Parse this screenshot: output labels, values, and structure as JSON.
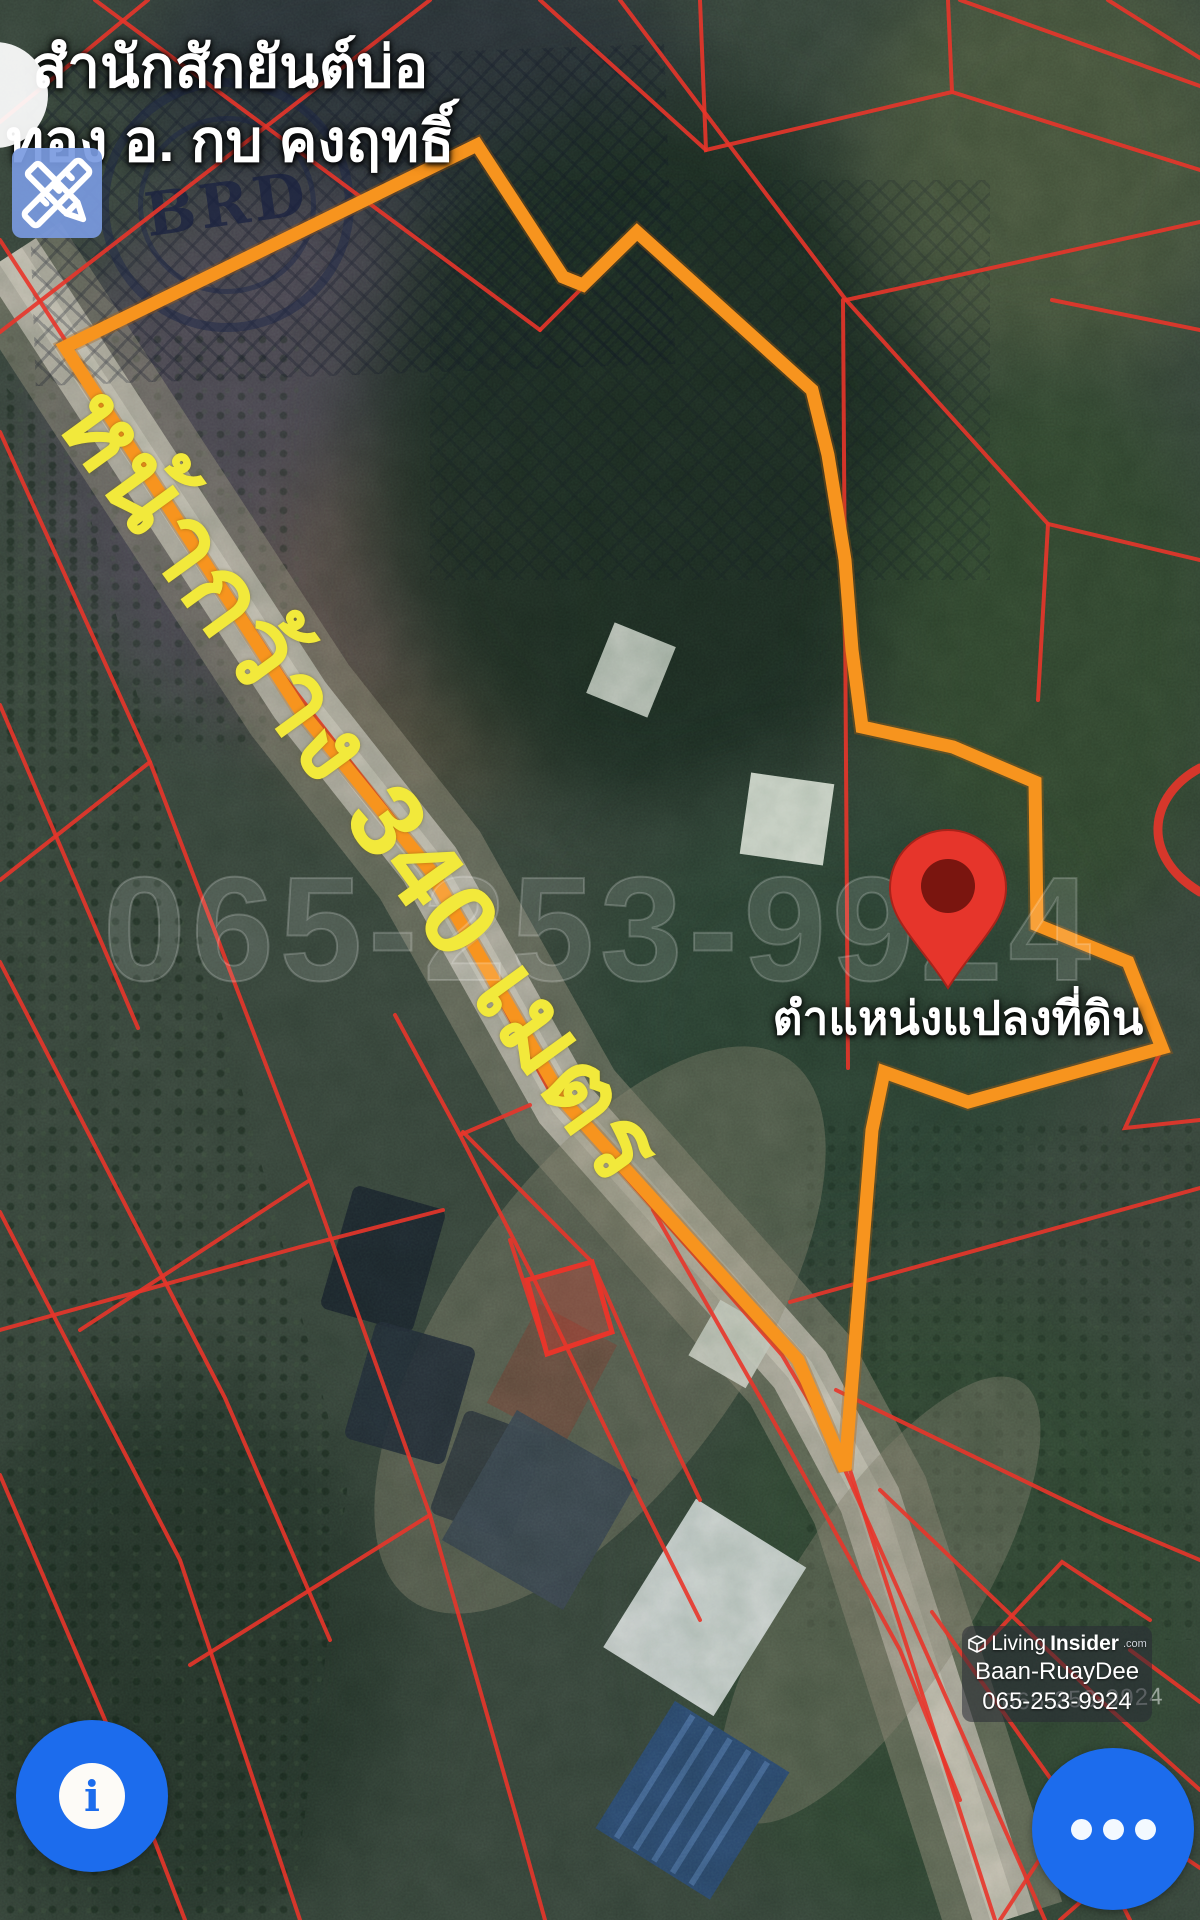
{
  "map": {
    "place_label_line1": "สำนักสักยันต์บ่อ",
    "place_label_line2": "ทอง อ. กบ คงฤทธิ์",
    "frontage_label": "หน้ากว้าง 340 เมตร",
    "pin_label": "ตำแหน่งแปลงที่ดิน",
    "stamp_text": "BRD",
    "watermark_phone_large": "065-253-9924",
    "watermark_phone_small": "065-253-9924"
  },
  "watermark_card": {
    "brand_prefix": "Living",
    "brand_suffix": "Insider",
    "brand_tld": ".com",
    "agent_name": "Baan-RuayDee",
    "phone": "065-253-9924"
  },
  "controls": {
    "info_glyph": "i"
  },
  "colors": {
    "plot-orange": "#F7941E",
    "cadastral-red": "#E8352A",
    "highlight-yellow": "#F2E93B",
    "button-blue": "#1C6CED",
    "pin-red": "#E6352B",
    "pin-core": "#7A150F"
  }
}
